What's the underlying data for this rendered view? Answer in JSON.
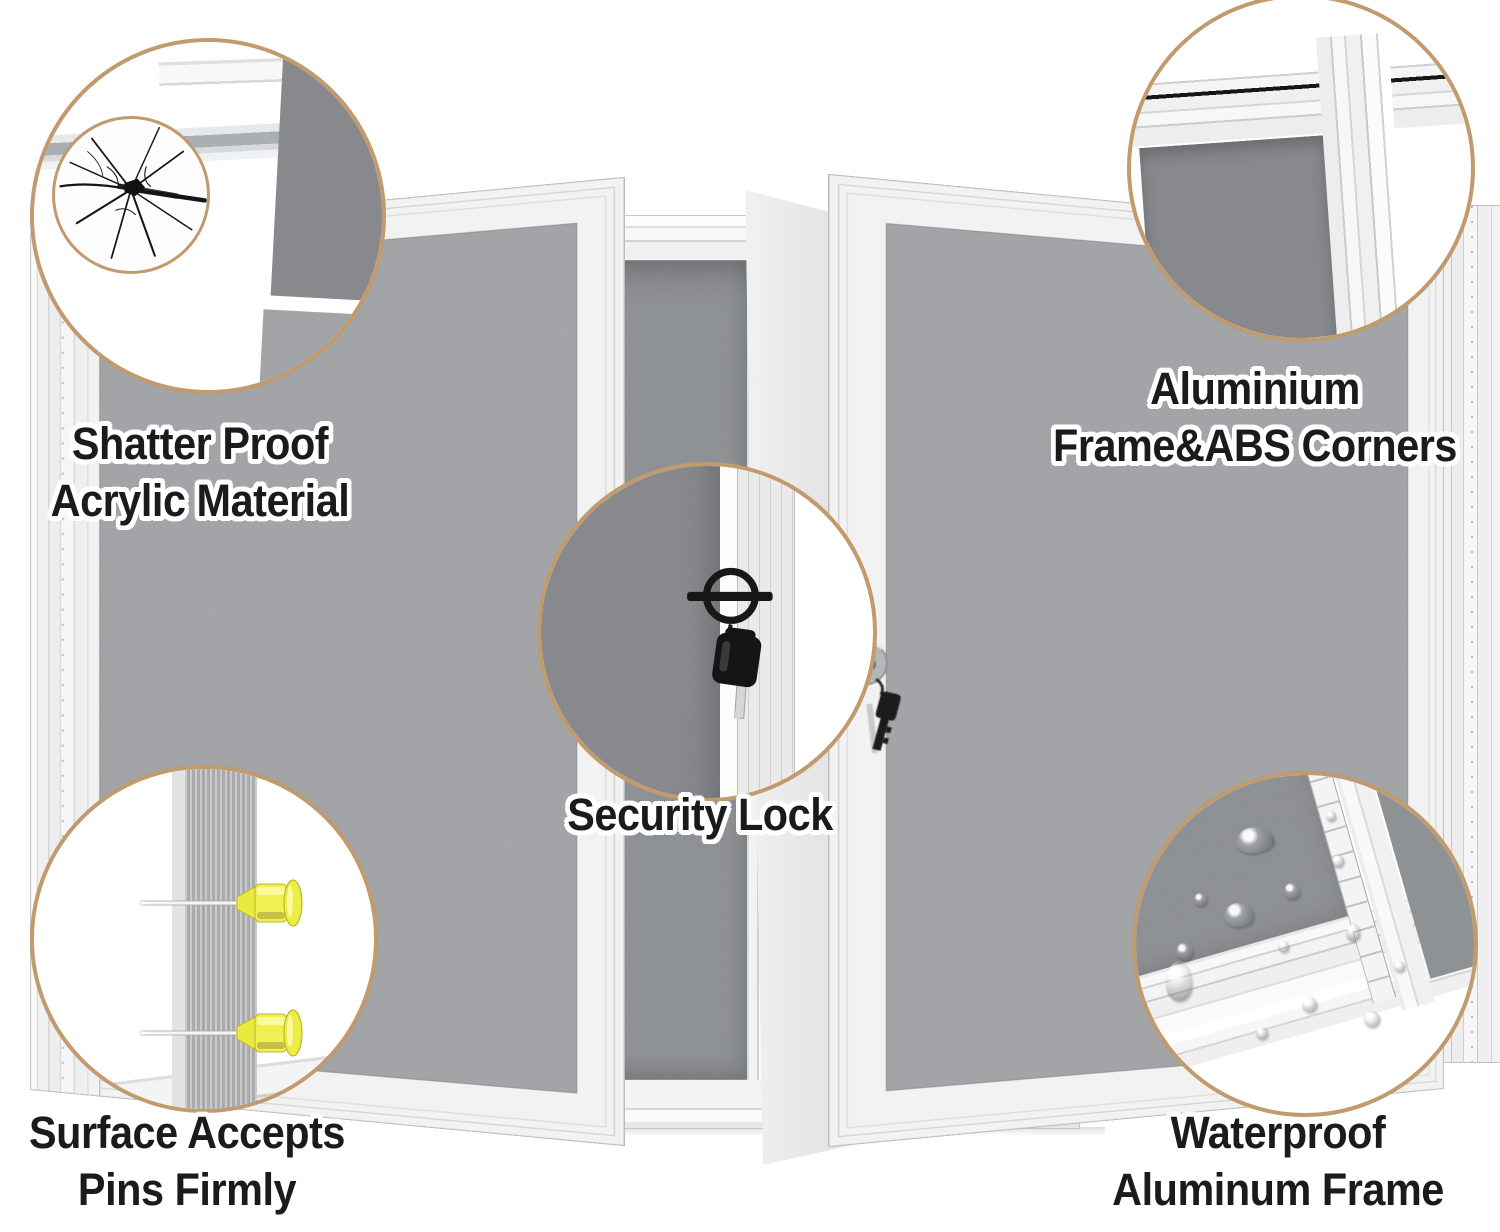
{
  "labels": {
    "shatter": {
      "line1": "Shatter Proof",
      "line2": "Acrylic Material"
    },
    "corners": {
      "line1": "Aluminium",
      "line2": "Frame&ABS Corners"
    },
    "lock": {
      "line1": "Security Lock"
    },
    "pins": {
      "line1": "Surface Accepts",
      "line2": "Pins Firmly"
    },
    "water": {
      "line1": "Waterproof",
      "line2": "Aluminum Frame"
    }
  },
  "colors": {
    "bubble_border": "#c19a6d",
    "text": "#1b1b1b",
    "text_outline": "#ffffff",
    "felt_door": "#a6a8aa",
    "felt_board": "#8d9093",
    "felt_dark": "#84868a",
    "frame": "#f3f3f3",
    "pin_yellow": "#ecec4a",
    "lock_black": "#1a1a1a",
    "key_silver": "#d9d9d9"
  }
}
